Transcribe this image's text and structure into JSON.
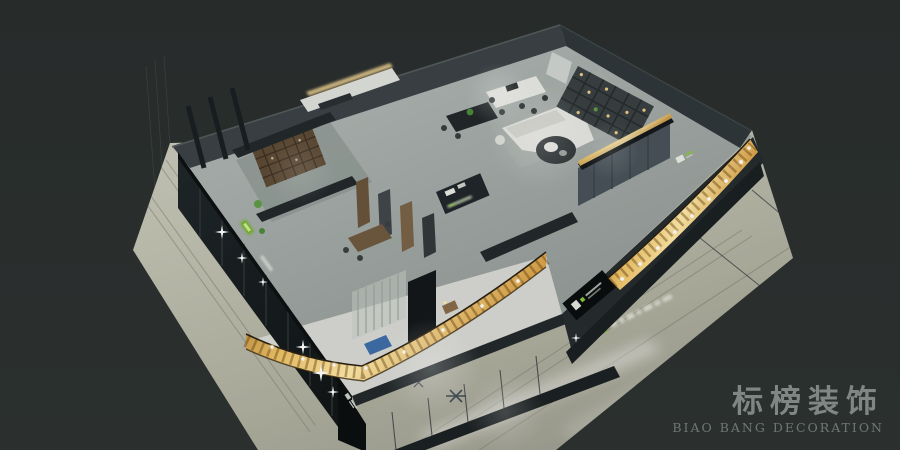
{
  "meta": {
    "description": "Night-time isometric 3D cutaway render of a decoration company showroom interior with illuminated gold LED fascia bands",
    "canvas": {
      "width": 900,
      "height": 450
    }
  },
  "watermark": {
    "brand_cn": "标榜装饰",
    "brand_en": "BIAO BANG DECORATION"
  },
  "palette": {
    "background": "#2c3130",
    "mall_floor": "#b9b9a9",
    "interior_floor": "#a3aaa7",
    "wall_dark": "#202628",
    "led_band_gold": "#e9b75f",
    "led_band_highlight": "#ffe9a8",
    "accent_green": "#74b32c",
    "sofa_white": "#e3e4df",
    "accent_blue": "#3e6ea8",
    "watermark_text": "#8e9694"
  },
  "icons": {
    "sparkle": "✦"
  }
}
